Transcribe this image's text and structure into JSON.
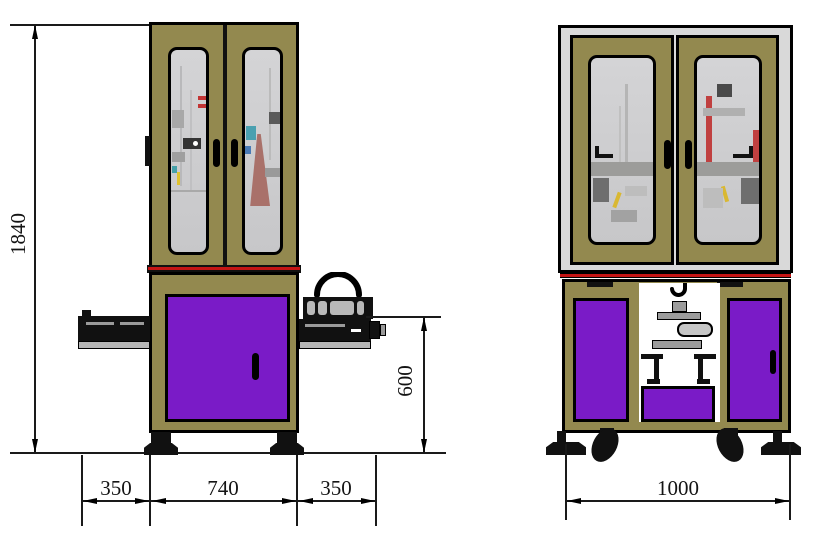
{
  "dimensions": {
    "overall_height": "1840",
    "conveyor_height": "600",
    "front_left_span": "350",
    "front_center_span": "740",
    "front_right_span": "350",
    "side_span": "1000"
  },
  "colors": {
    "cabinet_frame_olive": "#93894f",
    "panel_purple": "#7a1bc7",
    "glass_gray": "#cdcdcf",
    "safety_red": "#c51515",
    "outline_black": "#000000",
    "metal_gray": "#b5b5b5",
    "shell_gray": "#d9d9d9"
  },
  "icons": {
    "rotation_arc": "rotation-arc-icon",
    "hook": "hook-icon"
  }
}
